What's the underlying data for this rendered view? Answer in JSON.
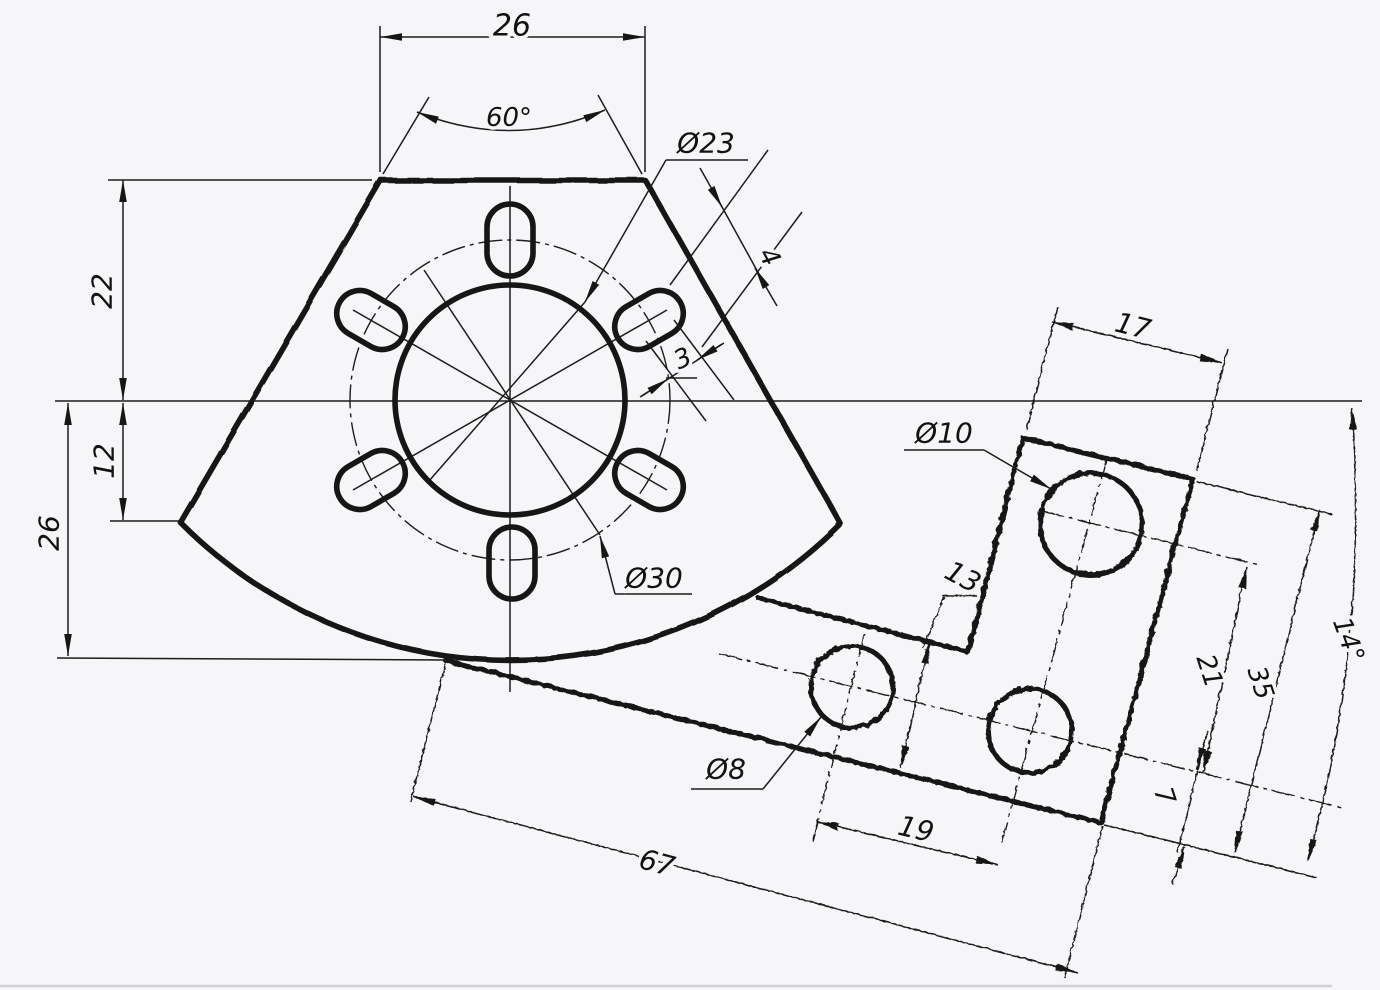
{
  "colors": {
    "background": "#f6f5f7",
    "ink": "#161616",
    "sheet_edge": "#cfcfd6"
  },
  "fan": {
    "top_width": "26",
    "apex_angle": "60°",
    "central_hole": "Ø23",
    "bolt_circle": "Ø30",
    "slot_length": "4",
    "slot_width": "3",
    "height_above_axis": "22",
    "vertex_drop": "12",
    "depth_below_axis": "26"
  },
  "plate": {
    "head_width": "17",
    "large_hole": "Ø10",
    "small_hole": "Ø8",
    "arm_width": "13",
    "axis_to_hole_top": "21",
    "head_length": "35",
    "axis_to_bottom_edge": "7",
    "hole_pitch": "19",
    "overall_length": "67",
    "incline_angle": "14°"
  }
}
